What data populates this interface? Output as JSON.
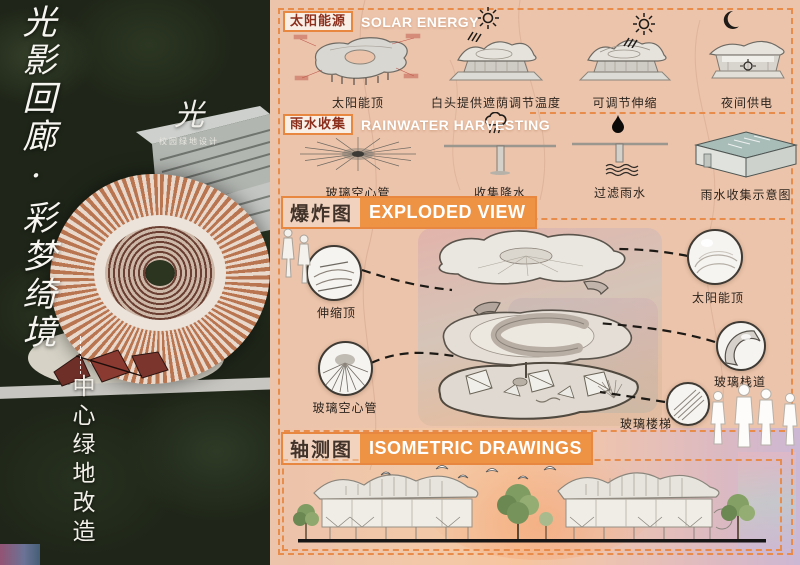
{
  "board": {
    "title_vertical": "光影回廊·彩梦绮境",
    "subtitle_vertical": "中心绿地改造"
  },
  "logo": {
    "mark": "光",
    "subtitle": "校园绿地设计"
  },
  "solar": {
    "tag": "太阳能源",
    "title": "SOLAR ENERGY",
    "items": [
      {
        "caption": "太阳能顶"
      },
      {
        "caption": "白头提供遮荫调节温度"
      },
      {
        "caption": "可调节伸缩"
      },
      {
        "caption": "夜间供电"
      }
    ]
  },
  "rain": {
    "tag": "雨水收集",
    "title": "RAINWATER HARVESTING",
    "items": [
      {
        "caption": "玻璃空心管"
      },
      {
        "caption": "收集降水"
      },
      {
        "caption": "过滤雨水"
      },
      {
        "caption": "雨水收集示意图"
      }
    ]
  },
  "exploded": {
    "tag": "爆炸图",
    "title": "EXPLODED VIEW",
    "callouts": [
      {
        "label": "伸缩顶"
      },
      {
        "label": "玻璃空心管"
      },
      {
        "label": "太阳能顶"
      },
      {
        "label": "玻璃栈道"
      },
      {
        "label": "玻璃楼梯"
      }
    ]
  },
  "isometric": {
    "tag": "轴测图",
    "title": "ISOMETRIC DRAWINGS"
  },
  "icons": {
    "sun": "sun-icon",
    "moon": "moon-icon",
    "rain_cloud": "rain-cloud-icon",
    "droplet": "droplet-icon",
    "birds": "bird-icon"
  },
  "colors": {
    "panel_bg": "#ecc4ab",
    "accent_orange": "#e8873f",
    "header_fill": "#ee9243",
    "tag_text": "#8c2f1d",
    "photo_bg": "#1f2619",
    "canopy_copper": "#b97450"
  }
}
